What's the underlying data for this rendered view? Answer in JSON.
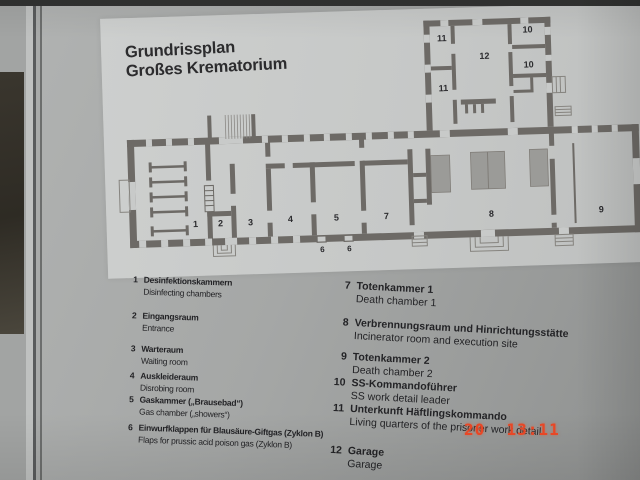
{
  "panel": {
    "title_line1": "Grundrissplan",
    "title_line2": "Großes Krematorium"
  },
  "plan": {
    "room_labels": {
      "r1": "1",
      "r2": "2",
      "r3": "3",
      "r4": "4",
      "r5": "5",
      "r6a": "6",
      "r6b": "6",
      "r7": "7",
      "r8": "8",
      "r9": "9",
      "r10a": "10",
      "r10b": "10",
      "r11a": "11",
      "r11b": "11",
      "r12": "12"
    }
  },
  "legend": {
    "left": [
      {
        "num": "1",
        "de": "Desinfektionskammern",
        "en": "Disinfecting chambers"
      },
      {
        "num": "2",
        "de": "Eingangsraum",
        "en": "Entrance"
      },
      {
        "num": "3",
        "de": "Warteraum",
        "en": "Waiting room"
      },
      {
        "num": "4",
        "de": "Auskleideraum",
        "en": "Disrobing room"
      },
      {
        "num": "5",
        "de": "Gaskammer („Brausebad“)",
        "en": "Gas chamber („showers“)"
      },
      {
        "num": "6",
        "de": "Einwurfklappen für Blausäure-Giftgas (Zyklon B)",
        "en": "Flaps for prussic acid poison gas (Zyklon B)"
      }
    ],
    "right": [
      {
        "num": "7",
        "de": "Totenkammer 1",
        "en": "Death chamber 1"
      },
      {
        "num": "8",
        "de": "Verbrennungsraum und Hinrichtungsstätte",
        "en": "Incinerator room and execution site"
      },
      {
        "num": "9",
        "de": "Totenkammer 2",
        "en": "Death chamber 2"
      },
      {
        "num": "10",
        "de": "SS-Kommandoführer",
        "en": "SS work detail leader"
      },
      {
        "num": "11",
        "de": "Unterkunft Häftlingskommando",
        "en": "Living quarters of the prisoner work detail"
      },
      {
        "num": "12",
        "de": "Garage",
        "en": "Garage"
      }
    ]
  },
  "camera": {
    "timestamp": "20  13:11"
  },
  "colors": {
    "panel_gray": "#a5a7a6",
    "sheet_gray": "#c6c8c7",
    "wall": "#6d6a66",
    "oven_fill": "#9b9b98",
    "text_dark": "#232326",
    "timestamp_red": "#e84726"
  }
}
